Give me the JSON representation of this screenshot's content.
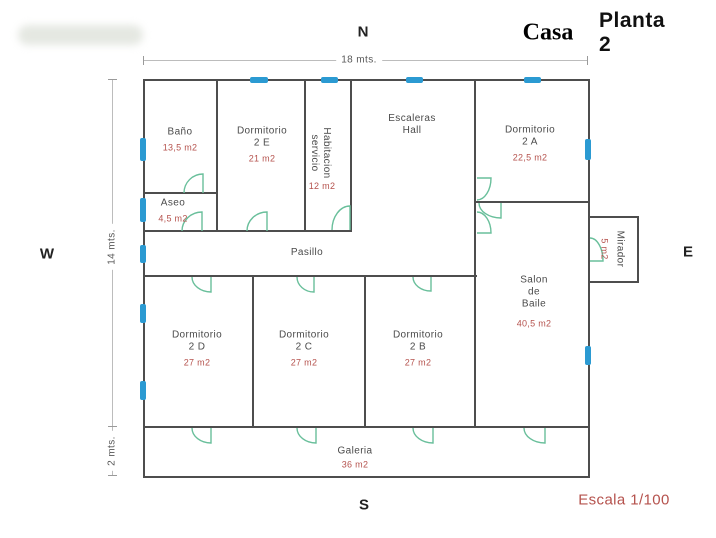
{
  "header": {
    "casa": "Casa",
    "planta": "Planta 2"
  },
  "compass": {
    "n": "N",
    "s": "S",
    "e": "E",
    "w": "W"
  },
  "footer": {
    "scale": "Escala 1/100"
  },
  "dims": {
    "top": "18 mts.",
    "left": "14 mts.",
    "left_lower": "2 mts."
  },
  "colors": {
    "wall": "#4d4d4d",
    "window": "#2b9ad2",
    "door": "#69bf9b",
    "room_text": "#4a4a4a",
    "area_text": "#b5524d",
    "dim_line": "#bcbcbc"
  },
  "plan": {
    "rooms": [
      {
        "id": "bano",
        "lines": [
          "Baño"
        ],
        "area": "13,5 m2",
        "cx": 180,
        "cy": 140
      },
      {
        "id": "dormitorio-2e",
        "lines": [
          "Dormitorio",
          "2 E"
        ],
        "area": "21 m2",
        "cx": 262,
        "cy": 145
      },
      {
        "id": "habitacion-servicio",
        "lines": [
          "Habitacion",
          "servicio"
        ],
        "area": "12 m2",
        "cx": 320,
        "cy": 153,
        "rotate": 90,
        "area_out": true,
        "area_cx": 322,
        "area_cy": 186
      },
      {
        "id": "escaleras-hall",
        "lines": [
          "Escaleras",
          "Hall"
        ],
        "area": null,
        "cx": 412,
        "cy": 125
      },
      {
        "id": "dormitorio-2a",
        "lines": [
          "Dormitorio",
          "2 A"
        ],
        "area": "22,5 m2",
        "cx": 530,
        "cy": 144
      },
      {
        "id": "aseo",
        "lines": [
          "Aseo"
        ],
        "area": "4,5 m2",
        "cx": 173,
        "cy": 211
      },
      {
        "id": "pasillo",
        "lines": [
          "Pasillo"
        ],
        "area": null,
        "cx": 307,
        "cy": 253
      },
      {
        "id": "mirador",
        "lines": [
          "Mirador"
        ],
        "area": "5 m2",
        "cx": 612,
        "cy": 249,
        "rotate": 90
      },
      {
        "id": "salon-de-baile",
        "lines": [
          "Salon",
          "de",
          "Baile"
        ],
        "area": "40,5 m2",
        "cx": 534,
        "cy": 302,
        "area_gap": 7
      },
      {
        "id": "dormitorio-2d",
        "lines": [
          "Dormitorio",
          "2 D"
        ],
        "area": "27 m2",
        "cx": 197,
        "cy": 349
      },
      {
        "id": "dormitorio-2c",
        "lines": [
          "Dormitorio",
          "2 C"
        ],
        "area": "27 m2",
        "cx": 304,
        "cy": 349
      },
      {
        "id": "dormitorio-2b",
        "lines": [
          "Dormitorio",
          "2 B"
        ],
        "area": "27 m2",
        "cx": 418,
        "cy": 349
      },
      {
        "id": "galeria",
        "lines": [
          "Galeria"
        ],
        "area": "36 m2",
        "cx": 355,
        "cy": 458,
        "area_gap": 1
      }
    ],
    "walls": [
      [
        143,
        79,
        447,
        2
      ],
      [
        143,
        79,
        2,
        399
      ],
      [
        588,
        79,
        2,
        399
      ],
      [
        143,
        476,
        447,
        2
      ],
      [
        143,
        192,
        75,
        2
      ],
      [
        143,
        230,
        209,
        2
      ],
      [
        475,
        201,
        115,
        2
      ],
      [
        143,
        275,
        334,
        2
      ],
      [
        143,
        426,
        447,
        2
      ],
      [
        216,
        79,
        2,
        153
      ],
      [
        304,
        79,
        2,
        153
      ],
      [
        350,
        79,
        2,
        153
      ],
      [
        474,
        79,
        2,
        198
      ],
      [
        252,
        275,
        2,
        153
      ],
      [
        364,
        275,
        2,
        153
      ],
      [
        474,
        275,
        2,
        153
      ],
      [
        589,
        216,
        49,
        1.5
      ],
      [
        637,
        216,
        1.5,
        67
      ],
      [
        589,
        281,
        49,
        1.5
      ]
    ],
    "windows": [
      [
        250,
        77,
        18,
        6
      ],
      [
        321,
        77,
        17,
        6
      ],
      [
        406,
        77,
        17,
        6
      ],
      [
        524,
        77,
        17,
        6
      ],
      [
        140,
        138,
        6,
        23
      ],
      [
        140,
        198,
        6,
        24
      ],
      [
        140,
        245,
        6,
        18
      ],
      [
        140,
        304,
        6,
        19
      ],
      [
        140,
        381,
        6,
        19
      ],
      [
        585,
        139,
        6,
        21
      ],
      [
        585,
        346,
        6,
        19
      ]
    ],
    "doors": [
      [
        184,
        174,
        19,
        19,
        "up"
      ],
      [
        182,
        212,
        20,
        19,
        "up"
      ],
      [
        247,
        212,
        20,
        19,
        "up"
      ],
      [
        332,
        206,
        18,
        24,
        "up"
      ],
      [
        477,
        178,
        14,
        22,
        "right-down"
      ],
      [
        479,
        203,
        22,
        15,
        "down"
      ],
      [
        477,
        212,
        14,
        21,
        "right-up"
      ],
      [
        590,
        238,
        13,
        23,
        "right-up"
      ],
      [
        192,
        277,
        19,
        15,
        "down"
      ],
      [
        297,
        277,
        17,
        15,
        "down"
      ],
      [
        413,
        277,
        18,
        14,
        "down"
      ],
      [
        192,
        428,
        19,
        15,
        "down"
      ],
      [
        297,
        428,
        19,
        15,
        "down"
      ],
      [
        413,
        428,
        20,
        15,
        "down"
      ],
      [
        524,
        428,
        21,
        15,
        "down"
      ]
    ]
  }
}
